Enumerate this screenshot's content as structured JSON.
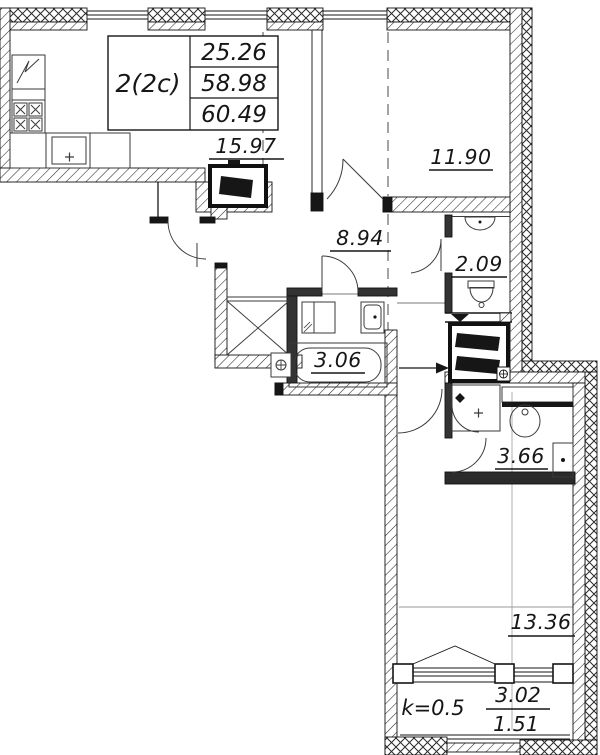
{
  "apartment": {
    "type_label": "2(2c)",
    "area_living": "25.26",
    "area_total": "58.98",
    "area_total_with_summer": "60.49"
  },
  "rooms": {
    "kitchen_living": "15.97",
    "bedroom": "11.90",
    "hallway": "8.94",
    "wc": "2.09",
    "bathroom_small": "3.06",
    "bathroom": "3.66",
    "living_room": "13.36"
  },
  "balcony": {
    "coefficient": "k=0.5",
    "area_full": "3.02",
    "area_reduced": "1.51"
  },
  "colors": {
    "line": "#161616",
    "background": "#ffffff"
  }
}
